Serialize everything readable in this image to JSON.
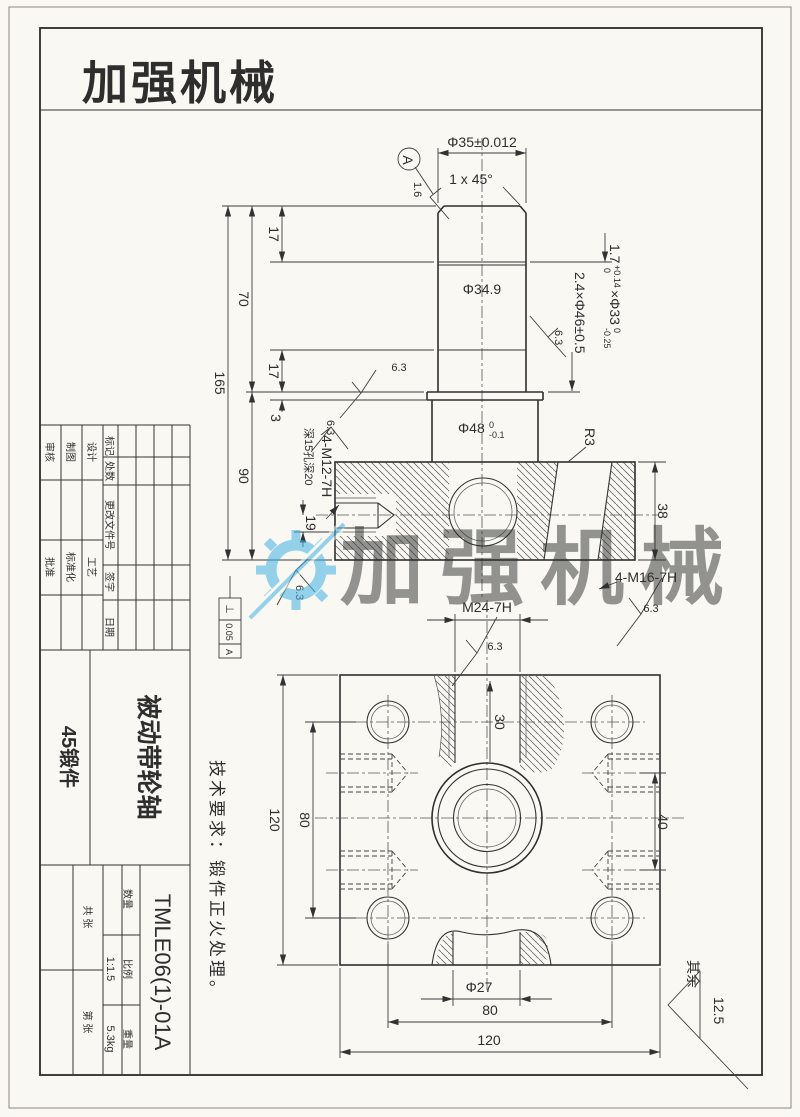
{
  "logo": {
    "text": "加强机械",
    "color": "#e0251f"
  },
  "watermark": {
    "text": "加强机械",
    "color": "#3fb3e2"
  },
  "notes": {
    "tech_req": "技术要求：锻件正火处理。",
    "others_label": "其余",
    "others_value": "12.5"
  },
  "dims": {
    "phi35": "Φ35±0.012",
    "chamfer": "1 x 45°",
    "datum": "A",
    "r16": "1.6",
    "r63": "6.3",
    "g1_main": "1.7",
    "g1_sup": "+0.14",
    "g1_sub": "0",
    "g1b_main": "×Φ33",
    "g1b_sup": "0",
    "g1b_sub": "-0.25",
    "g2": "2.4×Φ46±0.5",
    "phi349": "Φ34.9",
    "phi48": "Φ48",
    "phi48_sup": "0",
    "phi48_sub": "-0.1",
    "r3": "R3",
    "d165": "165",
    "d70": "70",
    "d17": "17",
    "d3": "3",
    "d90": "90",
    "d19": "19",
    "d38": "38",
    "d30": "30",
    "d40": "40",
    "d120": "120",
    "d80": "80",
    "phi27": "Φ27",
    "m12": "4-M12-7H",
    "m12_depth": "深15孔深20",
    "m16": "4-M16-7H",
    "m24": "M24-7H",
    "fcf": {
      "symbol": "⊥",
      "value": "0.05",
      "datum": "A"
    }
  },
  "title_block": {
    "rev_headers": {
      "mark": "标记",
      "count": "处数",
      "doc_no": "更改文件号",
      "sign": "签字",
      "date": "日期"
    },
    "roles": {
      "design": "设计",
      "draft": "制图",
      "check": "审核",
      "process": "工艺",
      "standard": "标准化",
      "approve": "批准"
    },
    "part_name": "被动带轮轴",
    "material": "45锻件",
    "drawing_no": "TMLE06(1)-01A",
    "qty_label": "数量",
    "scale_label": "比例",
    "scale_value": "1:1.5",
    "weight_label": "重量",
    "weight_value": "5.3kg",
    "sheet_total": "共 张",
    "sheet_index": "第 张"
  }
}
